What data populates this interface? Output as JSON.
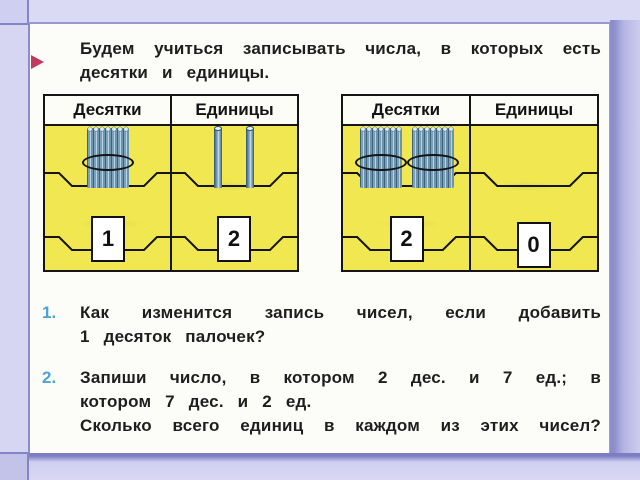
{
  "intro": {
    "line1": "Будем учиться записывать числа, в которых есть",
    "line2": "десятки и единицы."
  },
  "tables": [
    {
      "headers": [
        "Десятки",
        "Единицы"
      ],
      "dozens": {
        "bundles": 1,
        "value": "1"
      },
      "units": {
        "sticks": 2,
        "value": "2"
      }
    },
    {
      "headers": [
        "Десятки",
        "Единицы"
      ],
      "dozens": {
        "bundles": 2,
        "value": "2"
      },
      "units": {
        "sticks": 0,
        "value": "0"
      }
    }
  ],
  "questions": [
    {
      "number": "1.",
      "lines": [
        "Как изменится запись чисел, если добавить",
        "1 десяток палочек?"
      ]
    },
    {
      "number": "2.",
      "lines": [
        "Запиши число, в котором 2 дес. и 7 ед.; в",
        "котором 7 дес. и 2 ед.",
        "Сколько всего единиц в каждом из этих чисел?"
      ]
    }
  ],
  "colors": {
    "frame": "#cbcbee",
    "page": "#fcfcf9",
    "panel_yellow": "#f0e751",
    "marker_red": "#c23a60",
    "question_number_blue": "#4aa3da",
    "text": "#1e1e1e"
  }
}
